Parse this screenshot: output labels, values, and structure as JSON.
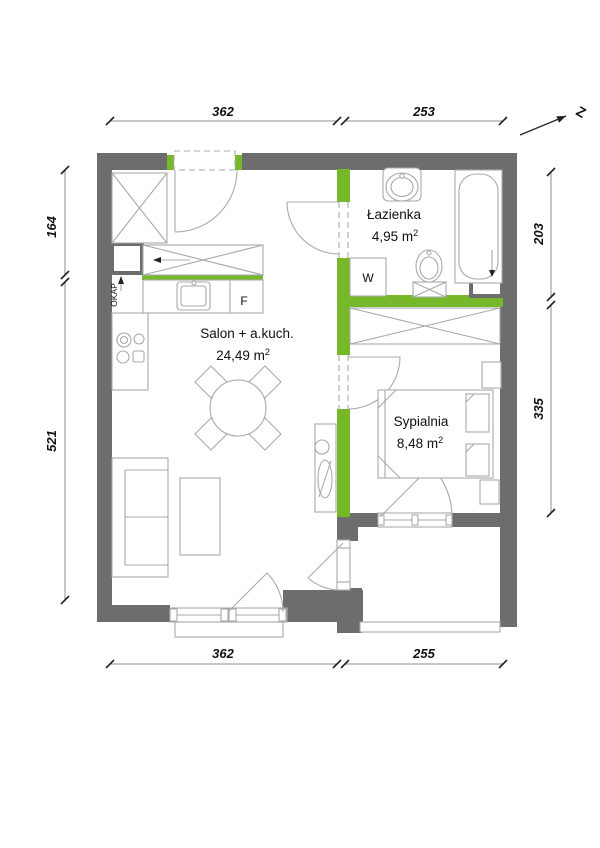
{
  "meta": {
    "type": "apartment-floor-plan"
  },
  "north": {
    "label": "Z"
  },
  "rooms": {
    "bathroom": {
      "name": "Łazienka",
      "area": "4,95 m",
      "area_sup": "2"
    },
    "living": {
      "name": "Salon + a.kuch.",
      "area": "24,49 m",
      "area_sup": "2"
    },
    "bedroom": {
      "name": "Sypialnia",
      "area": "8,48 m",
      "area_sup": "2"
    }
  },
  "labels": {
    "washing_machine": "W",
    "fridge": "F",
    "cooker_hood": "OKAP"
  },
  "dimensions": {
    "top": [
      "362",
      "253"
    ],
    "left": [
      "164",
      "521"
    ],
    "right": [
      "203",
      "335"
    ],
    "bottom": [
      "362",
      "255"
    ]
  },
  "colors": {
    "wall": "#6d6d6d",
    "partition": "#76b82a",
    "furniture": "#a9a9a9",
    "dim_line": "#8c8c8c",
    "text": "#111111",
    "bg": "#ffffff"
  }
}
